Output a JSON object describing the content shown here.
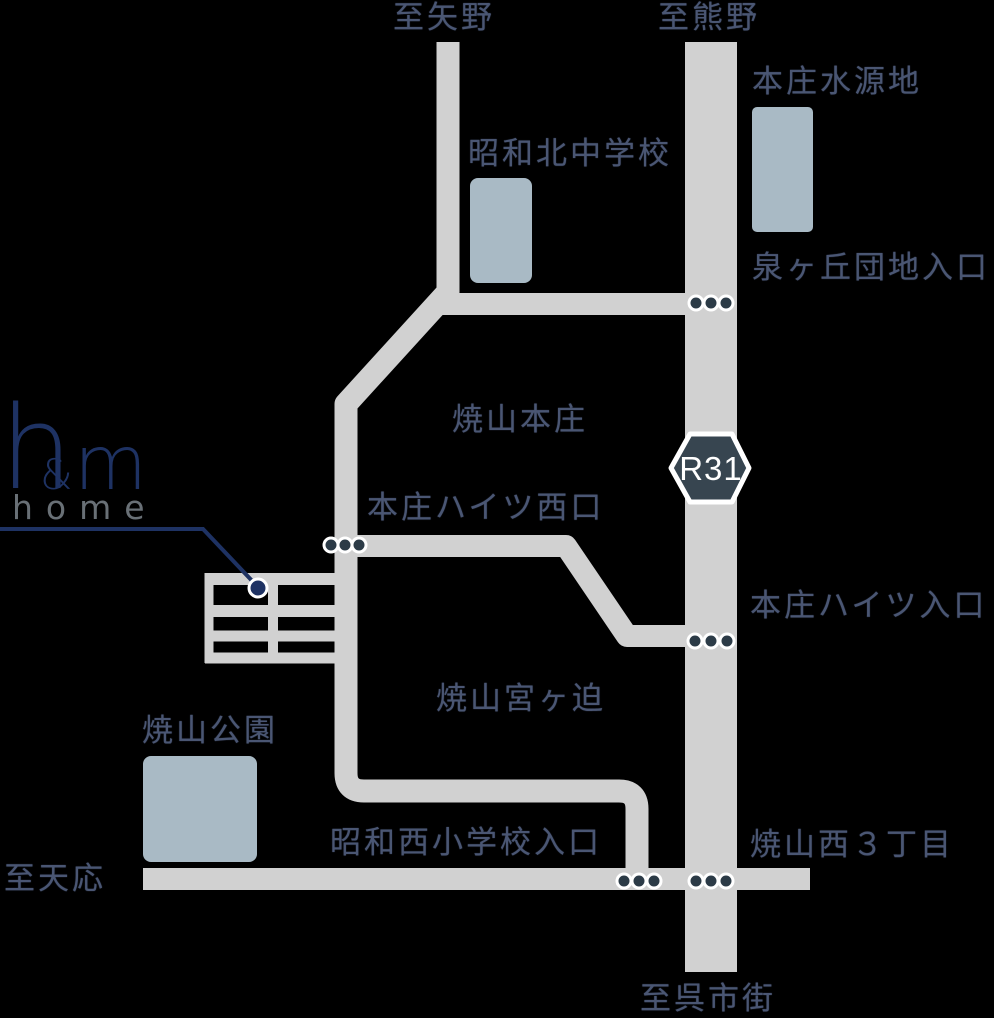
{
  "colors": {
    "background": "#000000",
    "road": "#d1d1d1",
    "building_fill": "#a9bac5",
    "label_text": "#4a5673",
    "badge_fill": "#374550",
    "badge_text": "#ffffff",
    "intersection_dot": "#2c3b47",
    "dot_ring": "#ffffff",
    "logo_navy": "#1e3263",
    "logo_gray": "#697076"
  },
  "logo": {
    "letter_h": "h",
    "ampersand": "&",
    "letter_m": "m",
    "subtitle": "home"
  },
  "route_badge": {
    "label": "R31"
  },
  "labels": {
    "to_yano": "至矢野",
    "to_kumano": "至熊野",
    "honjo_water_source": "本庄水源地",
    "izumigaoka_danchi_entrance": "泉ヶ丘団地入口",
    "showa_kita_junior_high": "昭和北中学校",
    "yakeyama_honjo": "焼山本庄",
    "honjo_heights_west_exit": "本庄ハイツ西口",
    "honjo_heights_entrance": "本庄ハイツ入口",
    "yakeyama_miyagasako": "焼山宮ヶ迫",
    "yakeyama_park": "焼山公園",
    "showa_nishi_elementary_entrance": "昭和西小学校入口",
    "yakeyama_nishi_3chome": "焼山西３丁目",
    "to_tenno": "至天応",
    "to_kure_city": "至呉市街"
  },
  "buildings": [
    {
      "name": "honjo-water-source-building",
      "label": "本庄水源地"
    },
    {
      "name": "showa-kita-junior-high-building",
      "label": "昭和北中学校"
    },
    {
      "name": "yakeyama-park-building",
      "label": "焼山公園"
    },
    {
      "name": "hm-home-shop",
      "label": "h&m home"
    }
  ]
}
